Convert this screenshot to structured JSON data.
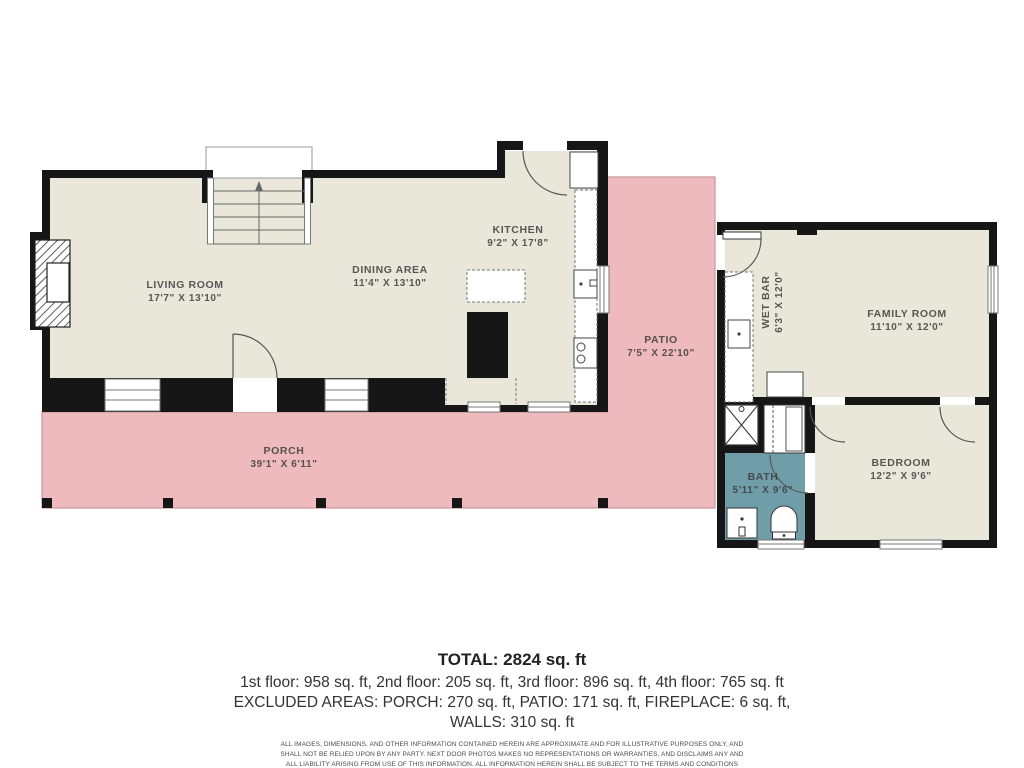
{
  "colors": {
    "floor": "#e9e6da",
    "outdoor": "#eebabe",
    "bath_floor": "#6f9ea9",
    "wall": "#161616",
    "line": "#555555",
    "label_text": "#3d3d3d"
  },
  "rooms": {
    "living_room": {
      "name": "LIVING ROOM",
      "dims": "17'7\" X 13'10\""
    },
    "dining_area": {
      "name": "DINING AREA",
      "dims": "11'4\" X 13'10\""
    },
    "kitchen": {
      "name": "KITCHEN",
      "dims": "9'2\" X 17'8\""
    },
    "patio": {
      "name": "PATIO",
      "dims": "7'5\" X 22'10\""
    },
    "porch": {
      "name": "PORCH",
      "dims": "39'1\" X 6'11\""
    },
    "wet_bar": {
      "name": "WET BAR",
      "dims": "6'3\" X 12'0\""
    },
    "family_room": {
      "name": "FAMILY ROOM",
      "dims": "11'10\" X 12'0\""
    },
    "bath": {
      "name": "BATH",
      "dims": "5'11\" X 9'6\""
    },
    "bedroom": {
      "name": "BEDROOM",
      "dims": "12'2\" X 9'6\""
    }
  },
  "summary": {
    "total": "TOTAL: 2824 sq. ft",
    "floors": "1st floor: 958 sq. ft, 2nd floor: 205 sq. ft, 3rd floor: 896 sq. ft, 4th floor: 765 sq. ft",
    "excluded_line1": "EXCLUDED AREAS: PORCH: 270 sq. ft, PATIO: 171 sq. ft, FIREPLACE: 6 sq. ft,",
    "excluded_line2": "WALLS: 310 sq. ft",
    "disclaimer": "ALL IMAGES, DIMENSIONS, AND OTHER INFORMATION CONTAINED HEREIN ARE APPROXIMATE AND FOR ILLUSTRATIVE PURPOSES ONLY, AND SHALL NOT BE RELIED UPON BY ANY PARTY. NEXT DOOR PHOTOS MAKES NO REPRESENTATIONS OR WARRANTIES, AND DISCLAIMS ANY AND ALL LIABILITY ARISING FROM USE OF THIS INFORMATION. ALL INFORMATION HEREIN SHALL BE SUBJECT TO THE TERMS AND CONDITIONS FOUND AT NEXTDOORPHOTOS.COM/TC."
  }
}
